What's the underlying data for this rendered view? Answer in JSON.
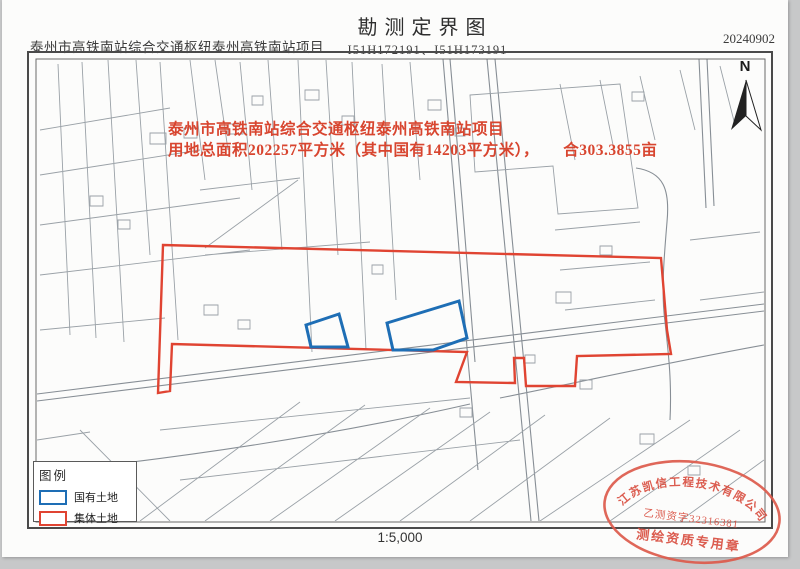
{
  "header": {
    "project_name": "泰州市高铁南站综合交通枢纽泰州高铁南站项目",
    "title": "勘测定界图",
    "sheet_numbers": "I51H172191、I51H173191",
    "date": "20240902"
  },
  "map": {
    "annotation": {
      "line1": "泰州市高铁南站综合交通枢纽泰州高铁南站项目",
      "line2": "用地总面积202257平方米（其中国有14203平方米），　　合303.3855亩"
    },
    "north_label": "N",
    "scale_text": "1:5,000"
  },
  "legend": {
    "title": "图例",
    "items": [
      {
        "label": "国有土地",
        "color": "#1e6eb5"
      },
      {
        "label": "集体土地",
        "color": "#e04432"
      }
    ]
  },
  "stamp": {
    "company": "江苏凯信工程技术有限公司",
    "license": "乙测资字32316381",
    "caption": "测绘资质专用章"
  },
  "colors": {
    "state_land_blue": "#1e6eb5",
    "collective_land_red": "#e04432",
    "annotation_red": "#d8452f",
    "stamp_red": "#d94f41",
    "cadastral_gray": "#9aa0a6"
  }
}
